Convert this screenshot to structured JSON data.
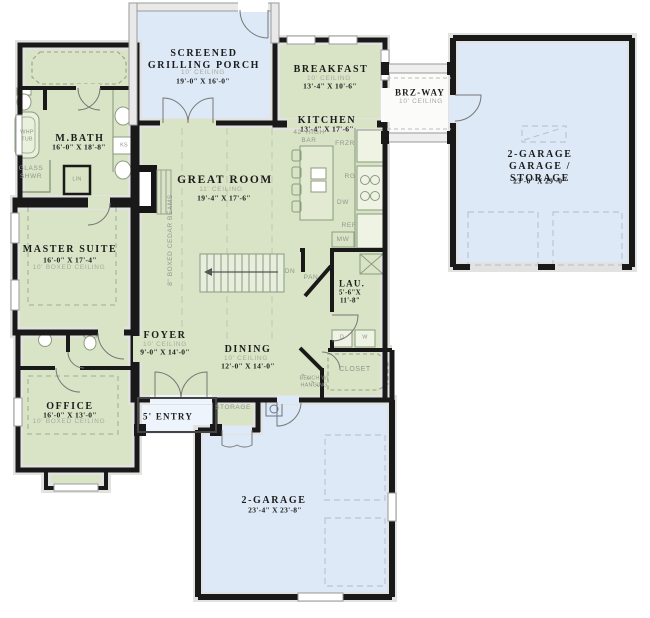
{
  "plan": {
    "rooms": {
      "screened_porch": {
        "name": "SCREENED\nGRILLING PORCH",
        "ceiling": "10' CEILING",
        "dims": "19'-0\" X 16'-0\""
      },
      "breakfast": {
        "name": "BREAKFAST",
        "ceiling": "10' CEILING",
        "dims": "13'-4\" X 10'-6\""
      },
      "kitchen": {
        "name": "KITCHEN",
        "dims": "13'-4\" X 17'-6\""
      },
      "brz_way": {
        "name": "BRZ-WAY",
        "ceiling": "10' CEILING"
      },
      "garage_right": {
        "name": "2-GARAGE\nGARAGE / STORAGE",
        "dims": "23'-0\" X 29'-0\""
      },
      "m_bath": {
        "name": "M.BATH",
        "dims": "16'-0\" X 18'-8\""
      },
      "master_suite": {
        "name": "MASTER SUITE",
        "dims": "16'-0\" X 17'-4\"",
        "ceiling": "10' BOXED CEILING"
      },
      "great_room": {
        "name": "GREAT ROOM",
        "ceiling": "11' CEILING",
        "dims": "19'-4\" X 17'-6\""
      },
      "foyer": {
        "name": "FOYER",
        "ceiling": "10' CEILING",
        "dims": "9'-0\" X 14'-0\""
      },
      "dining": {
        "name": "DINING",
        "ceiling": "10' CEILING",
        "dims": "12'-0\" X 14'-0\""
      },
      "laundry": {
        "name": "LAU.",
        "dims": "5'-6\"X\n11'-8\""
      },
      "office": {
        "name": "OFFICE",
        "dims": "16'-0\" X 13'-0\"",
        "ceiling": "10' BOXED CEILING"
      },
      "garage_bottom": {
        "name": "2-GARAGE",
        "dims": "23'-4\" X 23'-8\""
      }
    },
    "labels": {
      "entry": "5' ENTRY",
      "storage": "STORAGE",
      "closet": "CLOSET",
      "pantry": "PAN",
      "bench": "BENCH W/\nHANGING",
      "down": "DN",
      "beams": "8\" BOXED CEDAR BEAMS",
      "bar": "42' HIGH\nBAR"
    },
    "fixtures": {
      "whirlpool_tub": "WHP\nTUB",
      "glass_shower": "GLASS\nSHWR",
      "linen": "LIN",
      "knee_space": "KS",
      "dryer": "D",
      "washer": "W"
    },
    "appliances": {
      "freezer": "FRZR",
      "range": "RG",
      "refrigerator": "REF",
      "microwave": "MW",
      "dishwasher": "DW"
    },
    "colors": {
      "interior_fill": "#d9e4c6",
      "outdoor_fill": "#dde9f6",
      "wall": "#191919",
      "gray_text": "#8f968a"
    }
  }
}
